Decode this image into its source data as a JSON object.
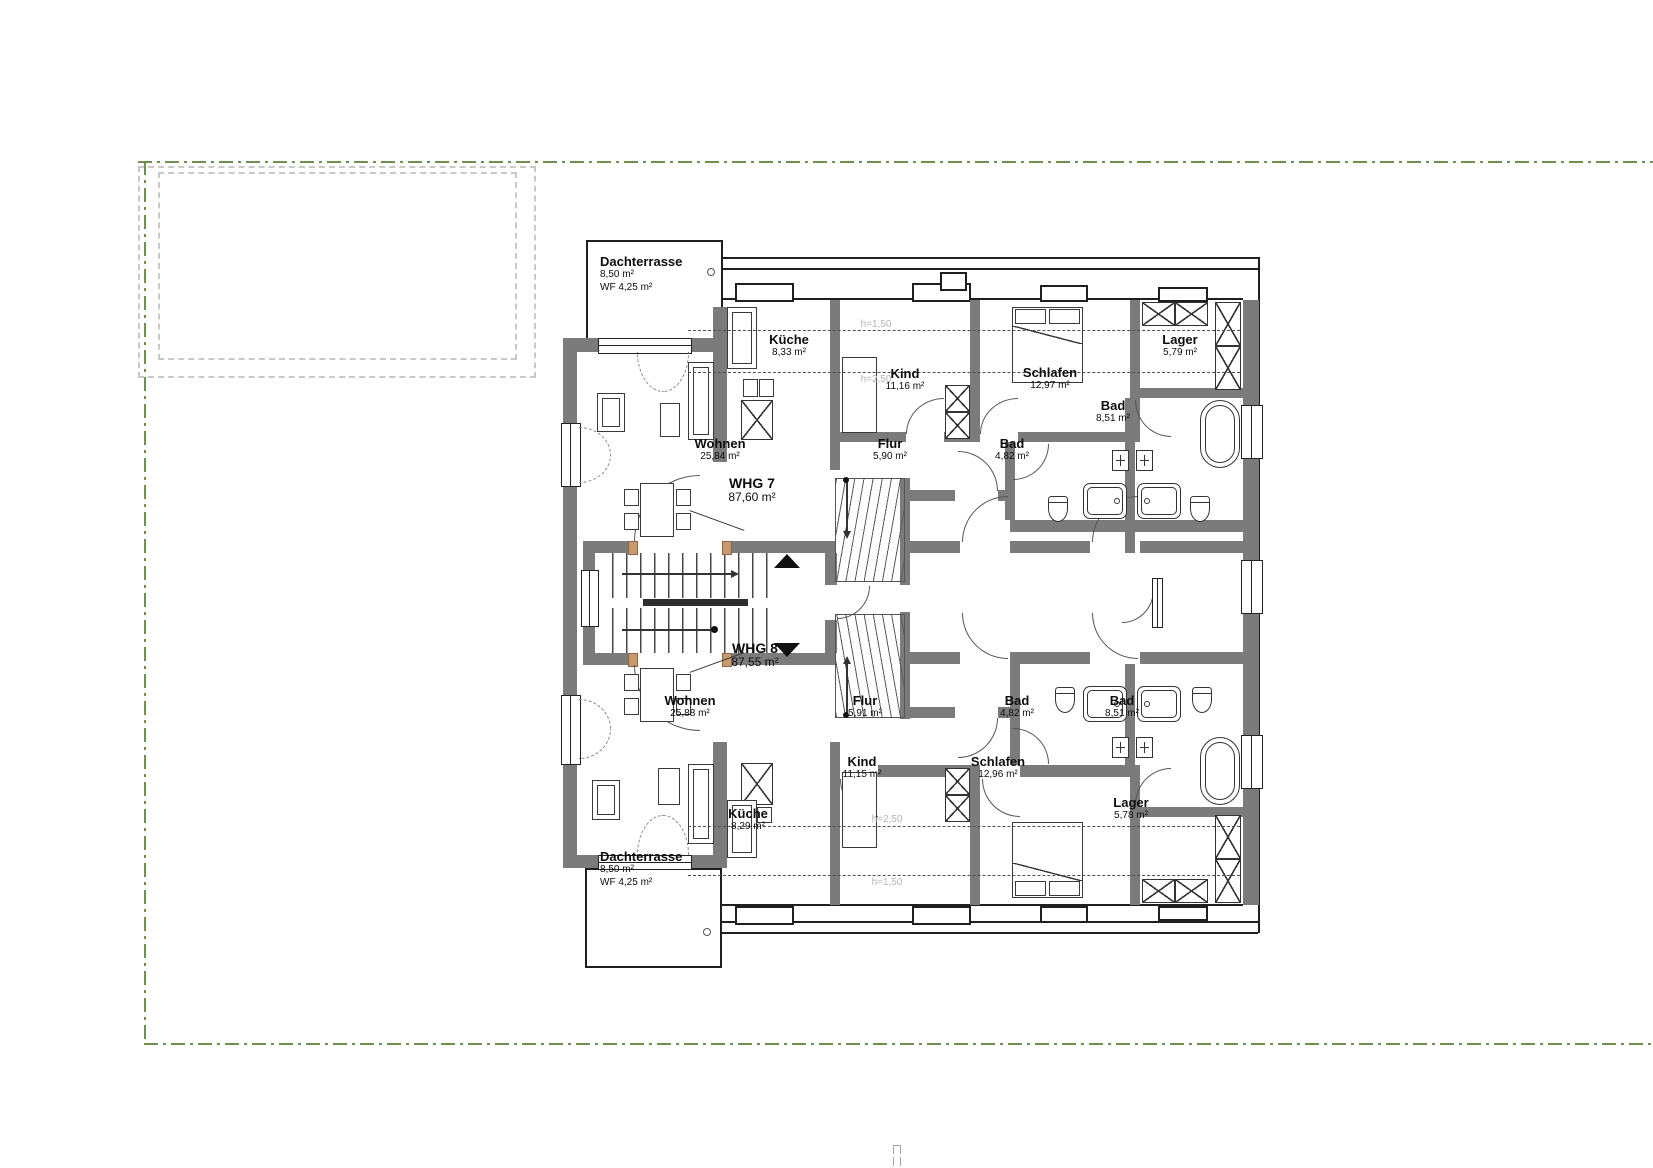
{
  "drawing": {
    "type": "floor-plan",
    "floor": "Dachgeschoss (attic floor) with two apartments",
    "boundary_color": "#6e9150",
    "wall_color": "#7b7b7b"
  },
  "heights": {
    "h150": "h=1,50",
    "h250": "h=2,50"
  },
  "apartments": {
    "whg7": {
      "label": "WHG 7",
      "area": "87,60 m²"
    },
    "whg8": {
      "label": "WHG 8",
      "area": "87,55 m²"
    }
  },
  "rooms": {
    "terrace7": {
      "name": "Dachterrasse",
      "area": "8,50 m²",
      "wf": "WF 4,25 m²"
    },
    "kueche7": {
      "name": "Küche",
      "area": "8,33 m²"
    },
    "kind7": {
      "name": "Kind",
      "area": "11,16 m²"
    },
    "schlafen7": {
      "name": "Schlafen",
      "area": "12,97 m²"
    },
    "lager7": {
      "name": "Lager",
      "area": "5,79 m²"
    },
    "wohnen7": {
      "name": "Wohnen",
      "area": "25,84 m²"
    },
    "flur7": {
      "name": "Flur",
      "area": "5,90 m²"
    },
    "bad7a": {
      "name": "Bad",
      "area": "4,82 m²"
    },
    "bad7b": {
      "name": "Bad",
      "area": "8,51 m²"
    },
    "wohnen8": {
      "name": "Wohnen",
      "area": "25,88 m²"
    },
    "flur8": {
      "name": "Flur",
      "area": "5,91 m²"
    },
    "bad8a": {
      "name": "Bad",
      "area": "4,82 m²"
    },
    "bad8b": {
      "name": "Bad",
      "area": "8,51 m²"
    },
    "kind8": {
      "name": "Kind",
      "area": "11,15 m²"
    },
    "schlafen8": {
      "name": "Schlafen",
      "area": "12,96 m²"
    },
    "kueche8": {
      "name": "Küche",
      "area": "8,29 m²"
    },
    "lager8": {
      "name": "Lager",
      "area": "5,78 m²"
    },
    "terrace8": {
      "name": "Dachterrasse",
      "area": "8,50 m²",
      "wf": "WF 4,25 m²"
    }
  }
}
